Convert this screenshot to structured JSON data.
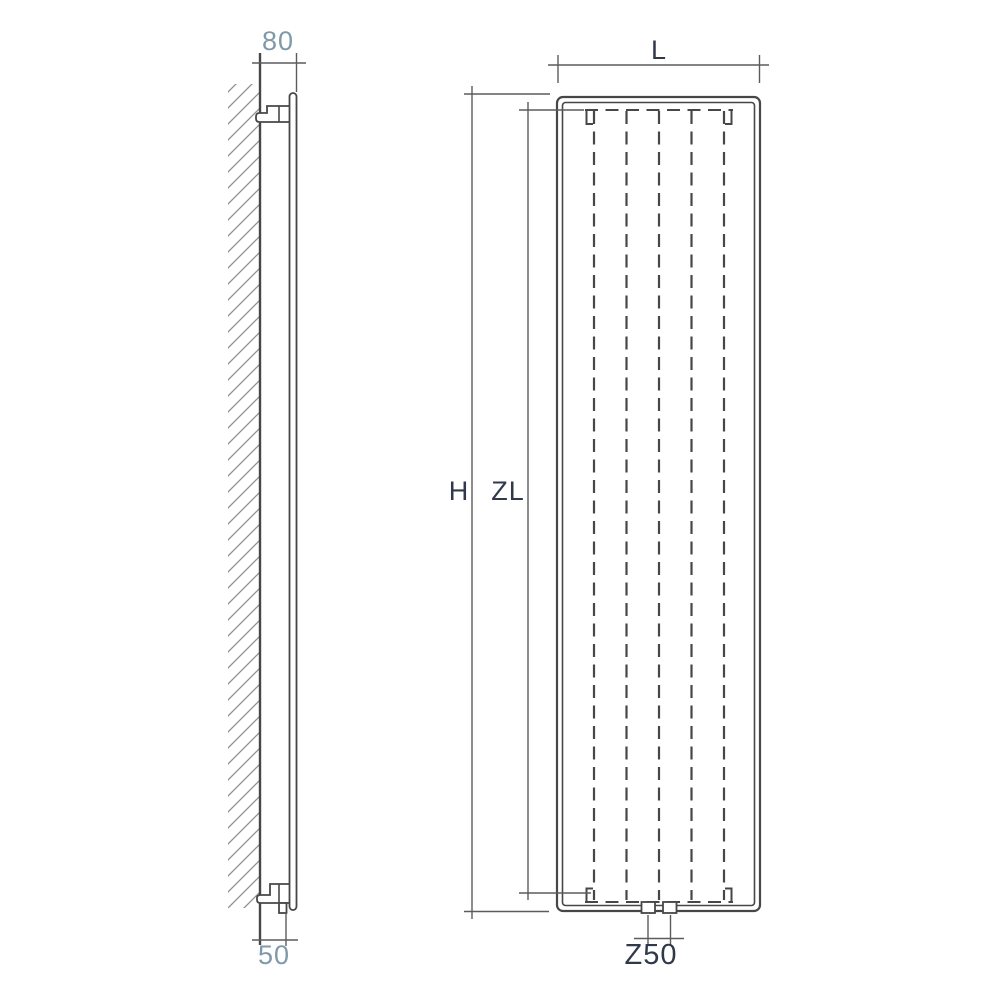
{
  "colors": {
    "line": "#474747",
    "dim": "#5c5c5c",
    "hatch": "#8f8f8f",
    "label-light": "#7f99a9",
    "label-dark": "#30384a",
    "bg": "#ffffff"
  },
  "side_view": {
    "dim_depth": "80",
    "dim_bottom": "50"
  },
  "front_view": {
    "dim_width": "L",
    "dim_height": "H",
    "dim_inner": "ZL",
    "dim_connection": "Z50"
  }
}
